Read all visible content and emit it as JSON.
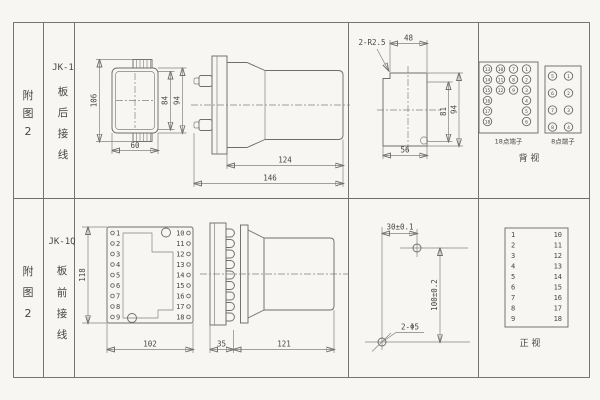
{
  "page": {
    "bg": "#f7f6f3",
    "line_color": "#6f6e6b",
    "text_color": "#474644"
  },
  "top": {
    "fig": [
      "附",
      "图",
      "2"
    ],
    "model": "JK-1",
    "mount": [
      "板",
      "后",
      "接",
      "线"
    ],
    "rear": {
      "h_total": "106",
      "h_inner": "84",
      "h_outer": "94",
      "w": "60"
    },
    "side": {
      "body": "124",
      "total": "146"
    },
    "cutout": {
      "corner": "2-R2.5",
      "top": "48",
      "inner_h": "81",
      "outer_h": "94",
      "bottom": "56"
    },
    "term": {
      "label18": "18点端子",
      "label8": "8点端子",
      "view": "背  视",
      "t18": [
        "13",
        "10",
        "7",
        "1",
        "14",
        "11",
        "8",
        "2",
        "15",
        "12",
        "9",
        "3",
        "16",
        "4",
        "17",
        "5",
        "18",
        "6"
      ],
      "t8": [
        "5",
        "1",
        "6",
        "2",
        "7",
        "3",
        "8",
        "4"
      ]
    }
  },
  "bottom": {
    "fig": [
      "附",
      "图",
      "2"
    ],
    "model": "JK-1Q",
    "mount": [
      "板",
      "前",
      "接",
      "线"
    ],
    "front": {
      "h": "118",
      "w": "102",
      "left": [
        "1",
        "2",
        "3",
        "4",
        "5",
        "6",
        "7",
        "8",
        "9"
      ],
      "right": [
        "10",
        "11",
        "12",
        "13",
        "14",
        "15",
        "16",
        "17",
        "18"
      ]
    },
    "side": {
      "plate": "35",
      "body": "121"
    },
    "drill": {
      "dx": "30±0.1",
      "dy": "100±0.2",
      "note": "2-Φ5"
    },
    "table": {
      "left": [
        "1",
        "2",
        "3",
        "4",
        "5",
        "6",
        "7",
        "8",
        "9"
      ],
      "right": [
        "10",
        "11",
        "12",
        "13",
        "14",
        "15",
        "16",
        "17",
        "18"
      ],
      "view": "正  视"
    }
  }
}
